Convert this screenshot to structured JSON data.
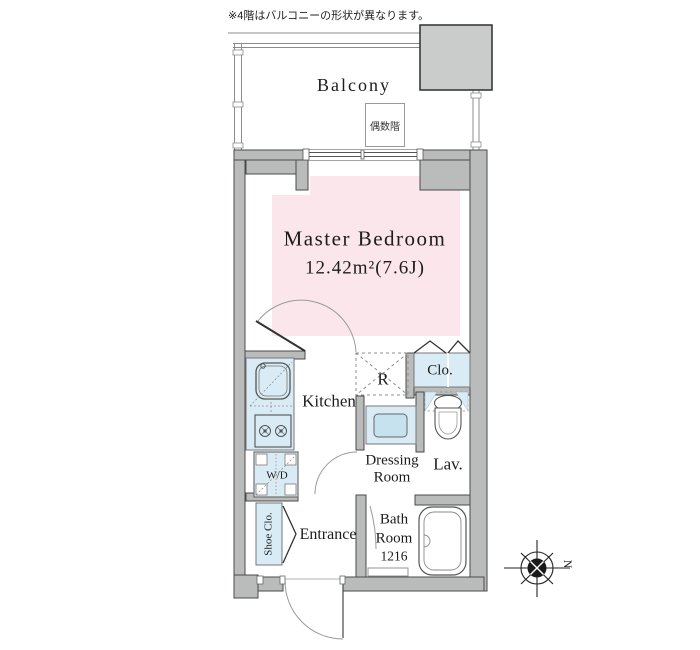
{
  "page": {
    "note": "※4階はバルコニーの形状が異なります。"
  },
  "balcony": {
    "label": "Balcony",
    "floor_note": "偶数階"
  },
  "rooms": {
    "master_bedroom": {
      "name": "Master Bedroom",
      "area": "12.42m²(7.6J)"
    },
    "kitchen": {
      "name": "Kitchen"
    },
    "refrigerator_space": {
      "label": "R"
    },
    "closet": {
      "label": "Clo."
    },
    "dressing_room": {
      "name_line1": "Dressing",
      "name_line2": "Room"
    },
    "lavatory": {
      "label": "Lav."
    },
    "washer_dryer": {
      "label": "W/D"
    },
    "shoe_closet": {
      "label": "Shoe Clo."
    },
    "entrance": {
      "name": "Entrance"
    },
    "bath_room": {
      "name_line1": "Bath",
      "name_line2": "Room",
      "size": "1216"
    }
  },
  "compass": {
    "north_label": "N"
  },
  "colors": {
    "bedroom_fill": "#fbe6ec",
    "fixture_fill": "#d9ecf5",
    "fixture_fill_dark": "#c6e2ef",
    "wall_fill": "#b9bcbb",
    "balcony_box_fill": "#c9cccb"
  }
}
